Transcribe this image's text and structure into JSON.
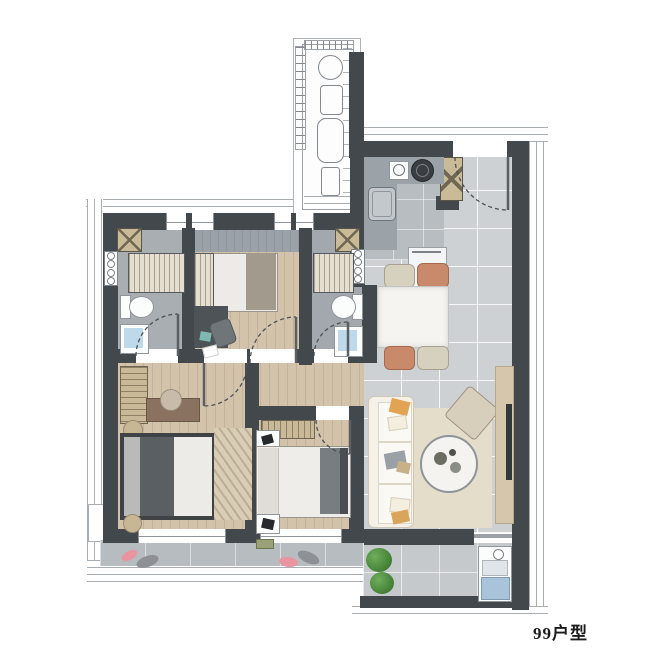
{
  "title": {
    "label": "99户型"
  },
  "rooms": [
    "entry",
    "kitchen",
    "dining",
    "living",
    "master-bedroom",
    "bedroom-2",
    "bedroom-3",
    "bathroom-1",
    "bathroom-2",
    "hall",
    "balcony-south",
    "balcony-service",
    "equipment-platform"
  ],
  "palette": {
    "wall": "#43484d",
    "wood_floor": "#d3c3ab",
    "tile_floor": "#cdd1d4",
    "bathroom_floor": "#a9aeb3",
    "balcony_floor": "#b7bcc0",
    "closet_wood": "#c9b998",
    "bed_dark": "#565b60",
    "duvet_white": "#edebe7",
    "sofa_cream": "#f5f1e8",
    "rug_beige": "#e4ddca",
    "chair_terracotta": "#c98a6b",
    "chair_beige": "#d6d0bf",
    "slipper_pink": "#e895a0",
    "plant_green": "#4e9143",
    "laundry_blue": "#a9c4da",
    "label_color": "#1b1b1b"
  }
}
